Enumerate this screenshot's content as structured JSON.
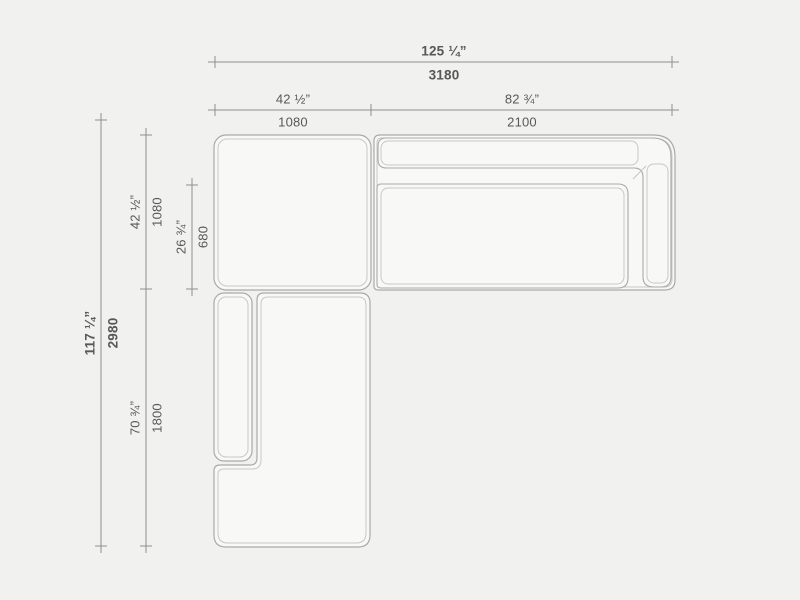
{
  "colors": {
    "background": "#f1f1ef",
    "sofa_fill": "#f8f8f6",
    "sofa_outline": "#aaaaa8",
    "sofa_inner_line": "#c7c7c5",
    "dimension_line": "#8e8e8c",
    "text_color": "#58585a"
  },
  "dimensions": {
    "width_total": {
      "inches": "125 ¼”",
      "mm": "3180"
    },
    "width_left": {
      "inches": "42 ½”",
      "mm": "1080"
    },
    "width_right": {
      "inches": "82 ¾”",
      "mm": "2100"
    },
    "depth_total": {
      "inches": "117 ¼”",
      "mm": "2980"
    },
    "depth_top": {
      "inches": "42 ½”",
      "mm": "1080"
    },
    "seat_depth": {
      "inches": "26 ¾”",
      "mm": "680"
    },
    "chaise_length": {
      "inches": "70 ¾”",
      "mm": "1800"
    }
  }
}
